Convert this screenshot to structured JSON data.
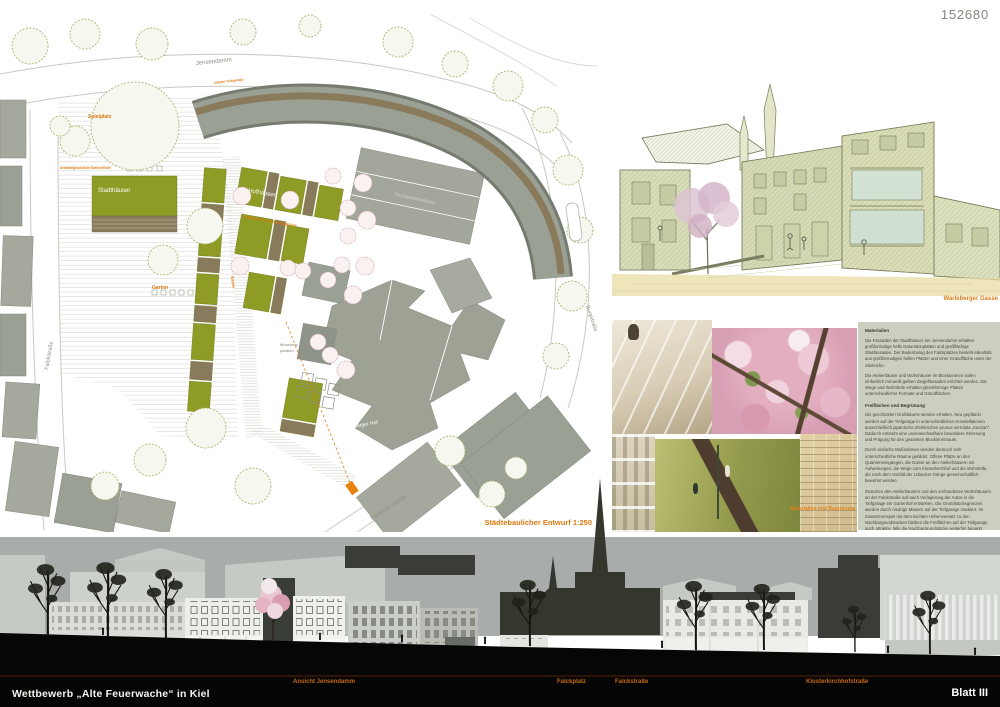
{
  "board": {
    "competition_number": "152680",
    "accent_color": "#dd7a10",
    "plan_green": "#8e9b25",
    "elevation_sky": "#a8acab"
  },
  "footer": {
    "title": "Wettbewerb „Alte Feuerwache“ in Kiel",
    "sheet_label": "Blatt III",
    "section_labels": [
      "Ansicht Jensendamm",
      "Falckplatz",
      "Falckstraße",
      "Klosterkirchhofstraße"
    ]
  },
  "site_plan": {
    "caption": "Städtebaulicher Entwurf 1:250",
    "streets": {
      "top": "Jensendamm",
      "west": "Falckstraße",
      "east": "Burgstraße",
      "south": "Dänische Straße"
    },
    "labels": {
      "spielplatz": "Spielplatz",
      "sommerlinde": "denkmalgeschützte Sommerlinde",
      "zufahrt": "Zufahrt Tiefgarage",
      "stadthaeuser": "Stadthäuser",
      "hofhaeuser": "Hofhäuser",
      "grossstadthaeuser": "Großstadthäuser",
      "wohnen_im_kirschgarten": "Wohnen im Kirschgarten",
      "garten": "Garten",
      "gasse": "Gasse",
      "kirchenverwaltung": "Kirchenverwaltung",
      "museumspavillon_line1": "Museums-",
      "museumspavillon_line2": "pavillon",
      "warleberger_hof": "Warleberger Hof"
    }
  },
  "sketch": {
    "caption": "Warleberger Gasse"
  },
  "photos": {
    "caption": "Materialien und Begrünung",
    "items": [
      "stone-plaza-steps",
      "cherry-blossoms",
      "plaster-facade",
      "green-courtyard-roof",
      "brick-wall"
    ]
  },
  "text_panel": {
    "heading_materials": "Materialien",
    "materials_paragraphs": [
      "Die Fassaden der Stadthäuser am Jensendamm erhalten großformatige helle Natursteinplatten und großflächige Glasfassaden. Der Bodenbelag des Falckplatzes besteht ebenfalls aus großformatigen hellen Platten und einer Grandfläche unter der Stieleiche.",
      "Die Atelierhäuser und Wohnhäuser im Blockinneren sollen einheitlich mit weiß-gelben Ziegelfassaden errichtet werden. Die Wege und Wohnhöfe erhalten gleichförmige Platten unterschiedlicher Formate und Grandflächen."
    ],
    "heading_open_space": "Freiflächen und Begrünung",
    "open_space_paragraphs": [
      "Die geschützten Großbäume werden erhalten. Neu gepflanzt werden auf der Tiefgarage in unterschiedlichen Konstellationen ausschließlich japanische Zierkirschen prunus serrulata „Kanzan“. Dadurch entsteht eine unverwechselbare besondere Stimmung und Prägung für den gesamten Blockinnenraum.",
      "Durch einfache Maßnahmen werden dennoch sehr unterschiedliche Räume gebildet. Offene Plätze an den Quartierseingängen, die Gasse an den Atelierhäusern mit Aufweitungen, die Wege zum Klosterkirchhof und die Wohnhöfe, die nach dem Vorbild der Lübecker Gänge gemeinschaftlich bewohnt werden.",
      "Zwischen den Atelierhäusern und den vorhandenen Wohnhäusern an der Falckstraße soll nach Verlagerung der Autos in die Tiefgarage ein Gartenhof entstehen. Die Grundstücksgrenzen werden durch niedrige Mauern auf der Tiefgarage markiert. Im Zusammenspiel mit dem leichten Höhenversatz zu den Nachbargrundstücken bleiben die Freiflächen auf der Tiefgarage auch attraktiv, falls die Nachbargrundstücke weiterhin beparkt werden.",
      "Die Zufahrt zur Tiefgarage der Kirchenverwaltung kann durch die neue Tiefgarage geführt werden. Dadurch entsteht auf dem Nachbargrundstück die Chance, die Stadthäuser am Jensendamm fortzuführen und ebenfalls attraktive Freiflächen im Innenhof zu gestalten.",
      "Die obersten Dachflächen der neuen Häuser werden kompakt begrünt, die Staffelgeschosse erhalten Dachterrassen."
    ]
  }
}
